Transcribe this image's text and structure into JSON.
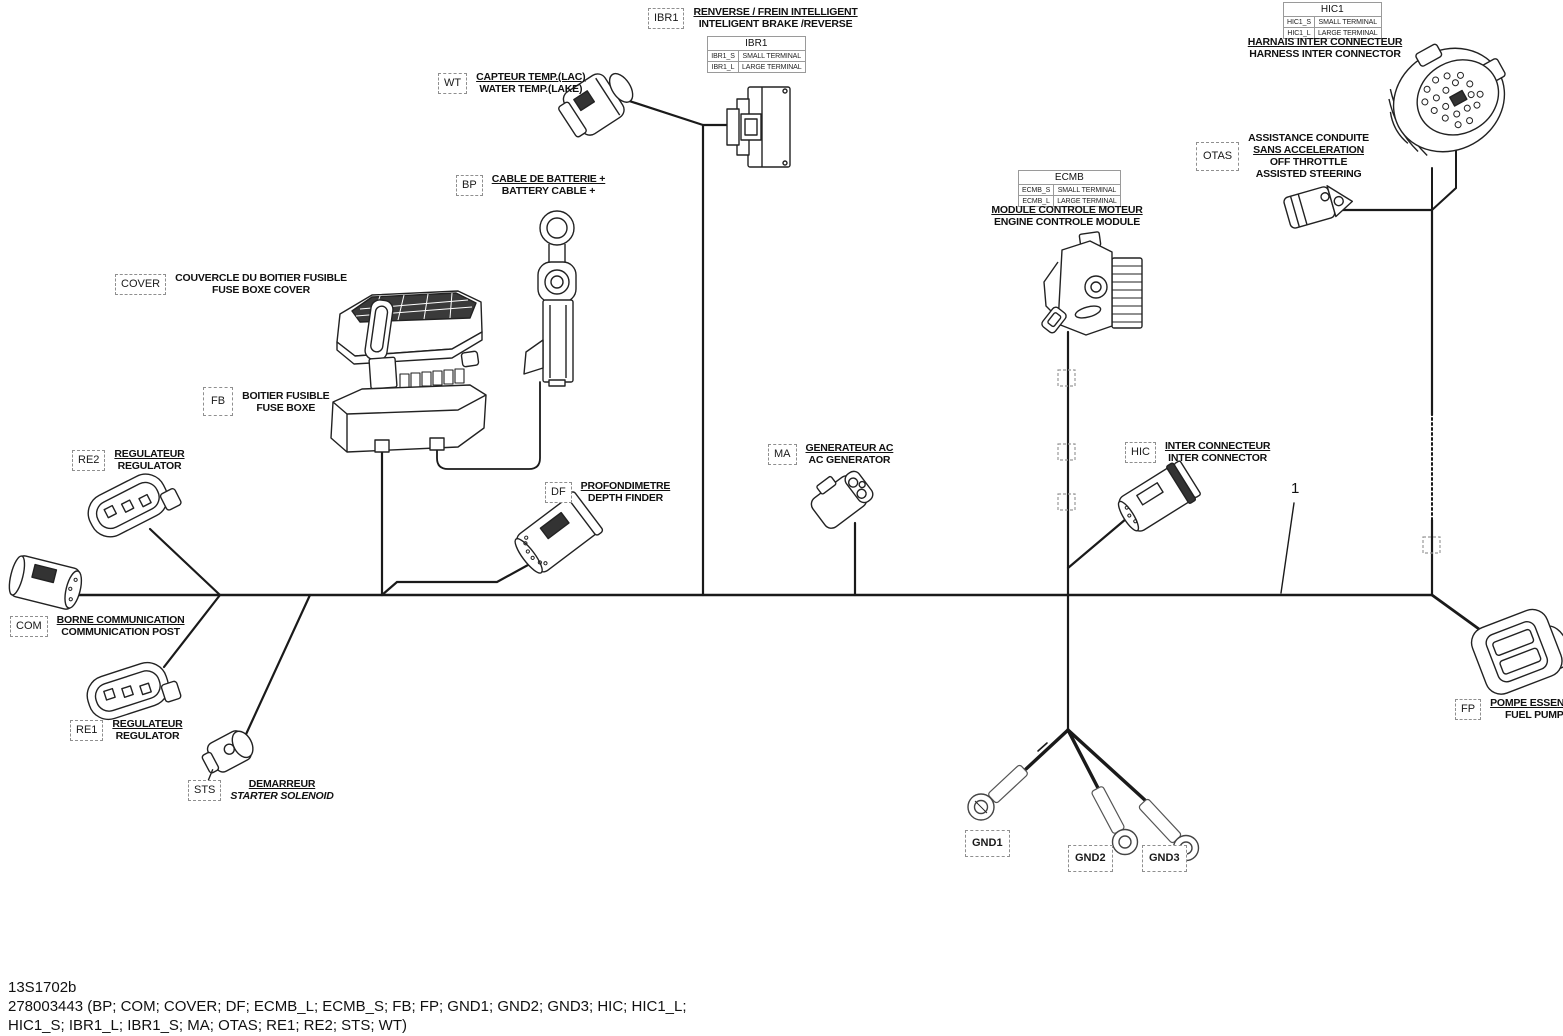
{
  "meta": {
    "drawing_code": "13S1702b",
    "part_list_line1": "278003443 (BP; COM; COVER; DF; ECMB_L; ECMB_S; FB; FP; GND1; GND2; GND3; HIC; HIC1_L;",
    "part_list_line2": "HIC1_S; IBR1_L; IBR1_S; MA; OTAS; RE1;  RE2; STS; WT)",
    "callout_1": "1"
  },
  "components": {
    "ibr1": {
      "code": "IBR1",
      "fr": "RENVERSE / FREIN INTELLIGENT",
      "en": "INTELIGENT BRAKE /REVERSE"
    },
    "wt": {
      "code": "WT",
      "fr": "CAPTEUR TEMP.(LAC)",
      "en": "WATER TEMP.(LAKE)"
    },
    "bp": {
      "code": "BP",
      "fr": "CABLE DE BATTERIE +",
      "en": "BATTERY CABLE +"
    },
    "cover": {
      "code": "COVER",
      "fr": "COUVERCLE DU BOITIER FUSIBLE",
      "en": "FUSE BOXE COVER"
    },
    "fb": {
      "code": "FB",
      "fr": "BOITIER FUSIBLE",
      "en": "FUSE BOXE"
    },
    "re2": {
      "code": "RE2",
      "fr": "REGULATEUR",
      "en": "REGULATOR"
    },
    "com": {
      "code": "COM",
      "fr": "BORNE COMMUNICATION",
      "en": "COMMUNICATION POST"
    },
    "re1": {
      "code": "RE1",
      "fr": "REGULATEUR",
      "en": "REGULATOR"
    },
    "sts": {
      "code": "STS",
      "fr": "DEMARREUR",
      "en": "STARTER SOLENOID"
    },
    "df": {
      "code": "DF",
      "fr": "PROFONDIMETRE",
      "en": "DEPTH FINDER"
    },
    "ma": {
      "code": "MA",
      "fr": "GENERATEUR AC",
      "en": "AC GENERATOR"
    },
    "hic": {
      "code": "HIC",
      "fr": "INTER CONNECTEUR",
      "en": "INTER CONNECTOR"
    },
    "otas": {
      "code": "OTAS",
      "fr1": "ASSISTANCE CONDUITE",
      "fr2": "SANS ACCELERATION",
      "en1": "OFF THROTTLE",
      "en2": "ASSISTED STEERING"
    },
    "ecmb": {
      "fr": "MODULE CONTROLE MOTEUR",
      "en": "ENGINE CONTROLE MODULE"
    },
    "hic1": {
      "fr": "HARNAIS INTER CONNECTEUR",
      "en": "HARNESS INTER CONNECTOR"
    },
    "fp": {
      "code": "FP",
      "fr": "POMPE ESSENCE",
      "en": "FUEL PUMP"
    },
    "gnd1": {
      "code": "GND1"
    },
    "gnd2": {
      "code": "GND2"
    },
    "gnd3": {
      "code": "GND3"
    }
  },
  "tables": {
    "ibr1": {
      "title": "IBR1",
      "rows": [
        [
          "IBR1_S",
          "SMALL TERMINAL"
        ],
        [
          "IBR1_L",
          "LARGE TERMINAL"
        ]
      ]
    },
    "ecmb": {
      "title": "ECMB",
      "rows": [
        [
          "ECMB_S",
          "SMALL TERMINAL"
        ],
        [
          "ECMB_L",
          "LARGE TERMINAL"
        ]
      ]
    },
    "hic1": {
      "title": "HIC1",
      "rows": [
        [
          "HIC1_S",
          "SMALL TERMINAL"
        ],
        [
          "HIC1_L",
          "LARGE TERMINAL"
        ]
      ]
    }
  }
}
